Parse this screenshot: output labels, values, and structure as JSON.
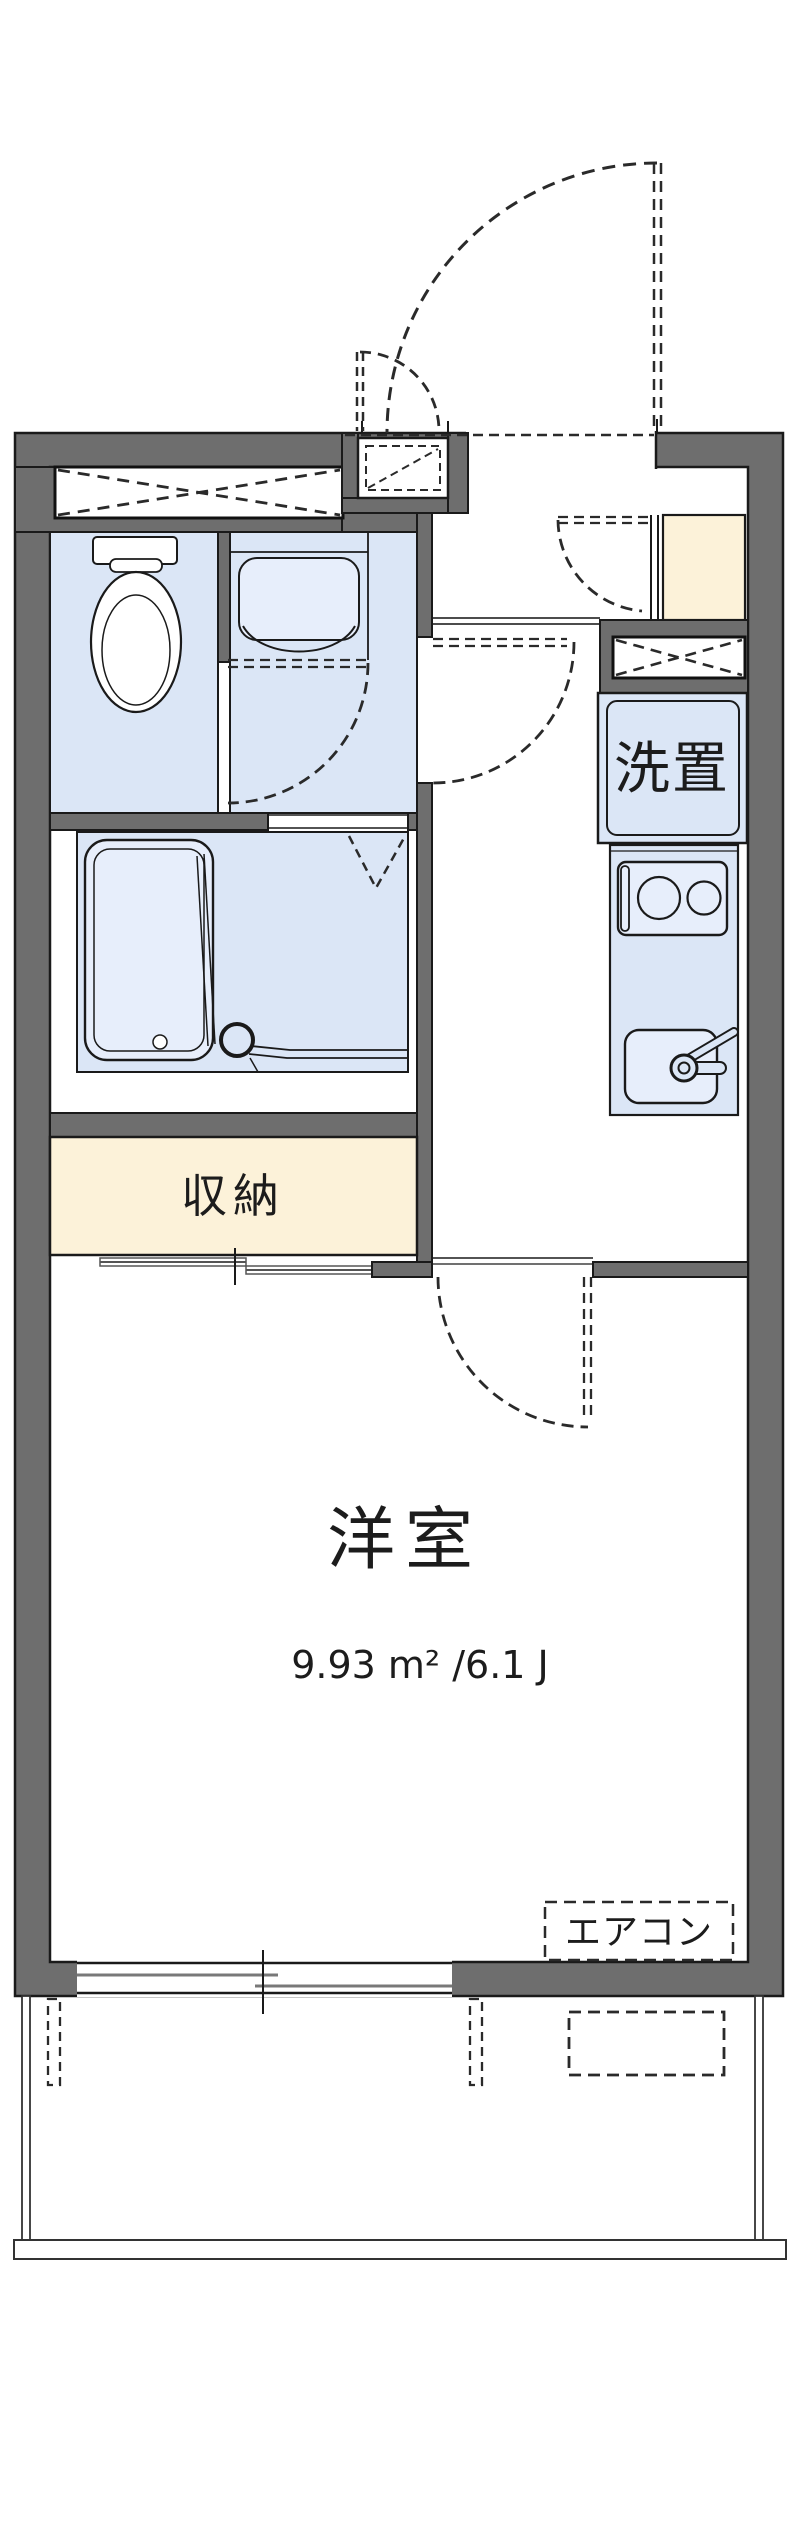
{
  "floorplan": {
    "labels": {
      "western_room": "洋室",
      "western_room_area": "9.93 m² /6.1 J",
      "closet": "収納",
      "washer": "洗置",
      "aircon": "エアコン"
    },
    "colors": {
      "wall_gray": "#6e6e6e",
      "line_black": "#1a1a1a",
      "room_blue": "#dbe6f6",
      "fixture_blue": "#e7eefb",
      "closet_cream": "#fcf2d9",
      "panel_gray": "#787878"
    }
  }
}
